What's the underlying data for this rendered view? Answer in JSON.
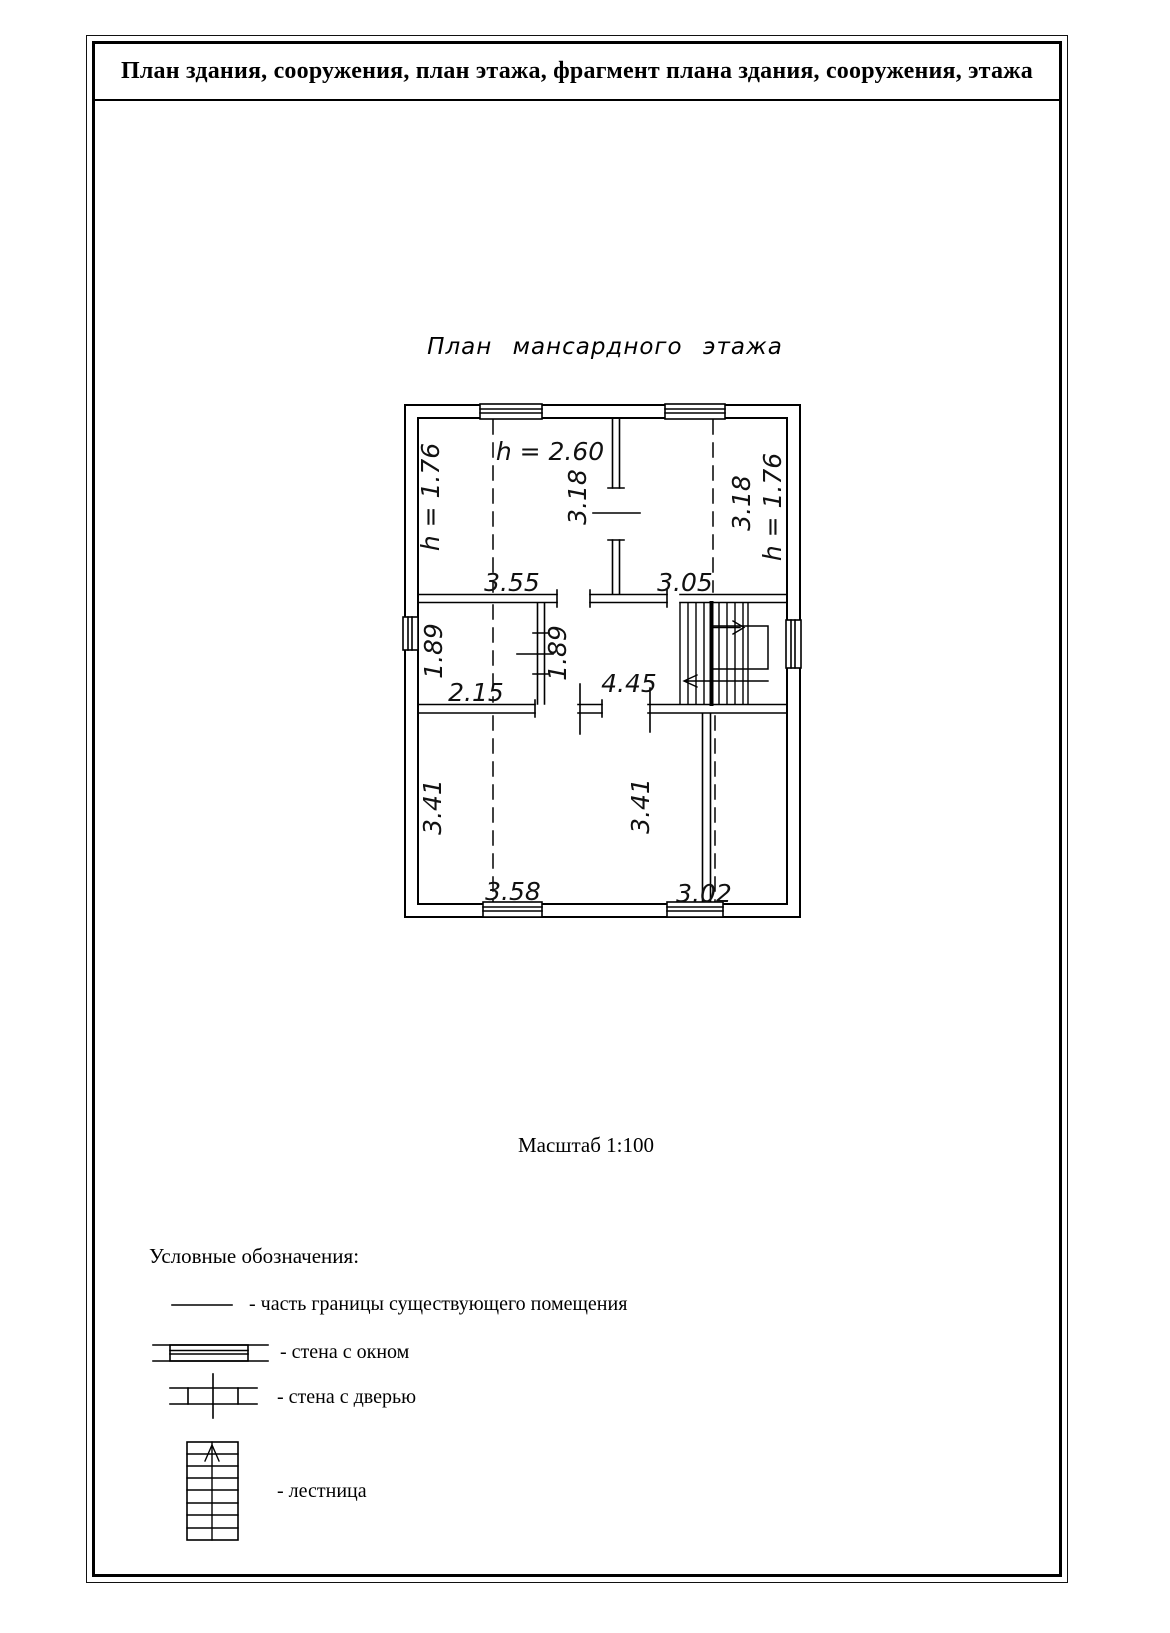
{
  "page": {
    "title": "План здания, сооружения, план этажа, фрагмент плана здания, сооружения, этажа"
  },
  "plan": {
    "caption": "План мансардного этажа",
    "dimensions": [
      {
        "text": "h = 1.76"
      },
      {
        "text": "h = 2.60"
      },
      {
        "text": "3.18"
      },
      {
        "text": "3.18"
      },
      {
        "text": "h = 1.76"
      },
      {
        "text": "3.55"
      },
      {
        "text": "3.05"
      },
      {
        "text": "1.89"
      },
      {
        "text": "2.15"
      },
      {
        "text": "1.89"
      },
      {
        "text": "4.45"
      },
      {
        "text": "3.41"
      },
      {
        "text": "3.41"
      },
      {
        "text": "3.58"
      },
      {
        "text": "3.02"
      }
    ]
  },
  "scale_note": "Масштаб 1:100",
  "legend": {
    "heading": "Условные обозначения:",
    "items": [
      {
        "symbol": "boundary-line",
        "label": "- часть границы существующего помещения"
      },
      {
        "symbol": "wall-with-window",
        "label": "- стена с окном"
      },
      {
        "symbol": "wall-with-door",
        "label": "- стена с дверью"
      },
      {
        "symbol": "stairs",
        "label": "- лестница"
      }
    ]
  },
  "colors": {
    "ink": "#000000",
    "paper": "#ffffff"
  }
}
